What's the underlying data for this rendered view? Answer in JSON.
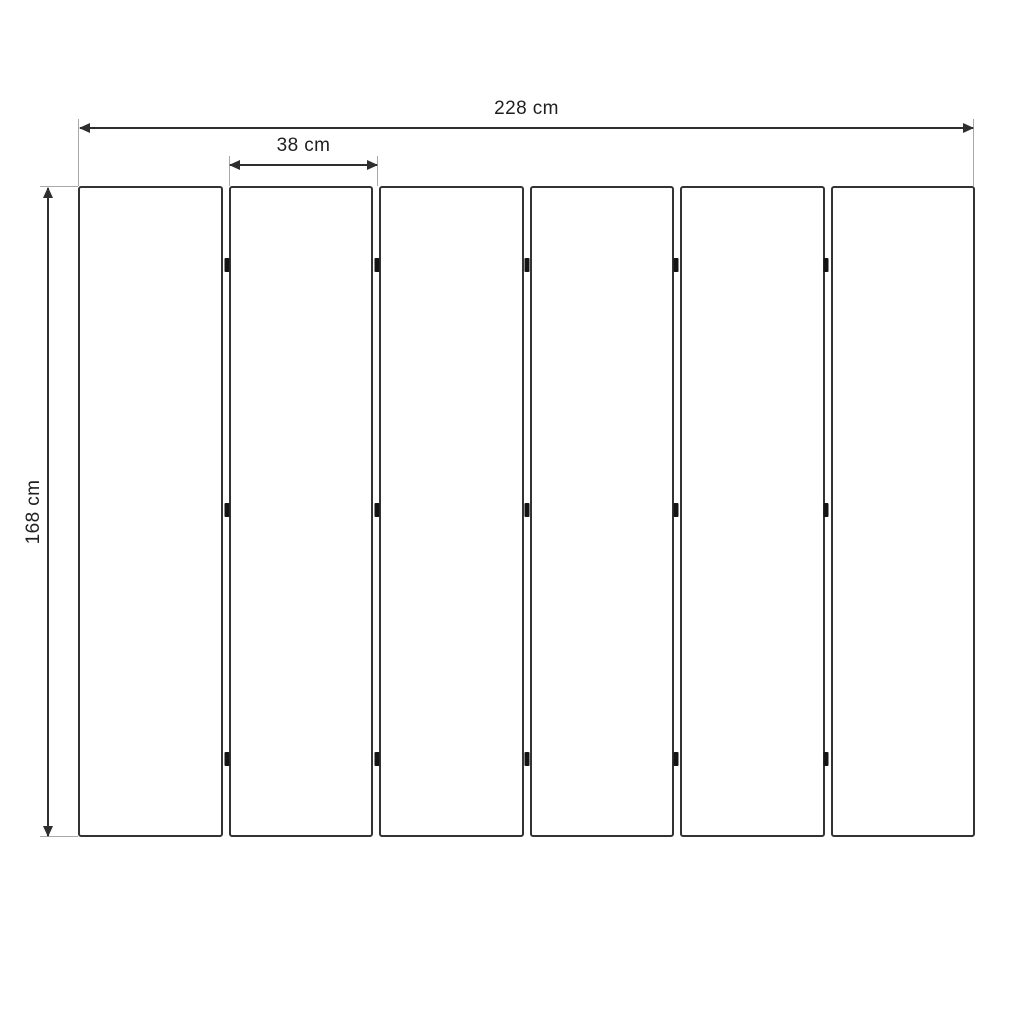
{
  "diagram": {
    "title": "panel-layout-dimension-drawing",
    "unit": "cm",
    "dimensions": {
      "total_width": {
        "label": "228 cm",
        "value": 228,
        "unit": "cm"
      },
      "panel_width": {
        "label": "38 cm",
        "value": 38,
        "unit": "cm"
      },
      "height": {
        "label": "168 cm",
        "value": 168,
        "unit": "cm"
      }
    },
    "panels": {
      "count": 6
    },
    "hinges": {
      "gap_columns": 5,
      "rows_percent": [
        12.1,
        49.8,
        88.0
      ]
    },
    "colors": {
      "background": "#ffffff",
      "panel_border": "#333333",
      "panel_fill": "#ffffff",
      "dimension_line": "#2e2e2e",
      "extension_line": "#a8a8a8",
      "hinge": "#141414",
      "text": "#1f1f1f"
    }
  }
}
